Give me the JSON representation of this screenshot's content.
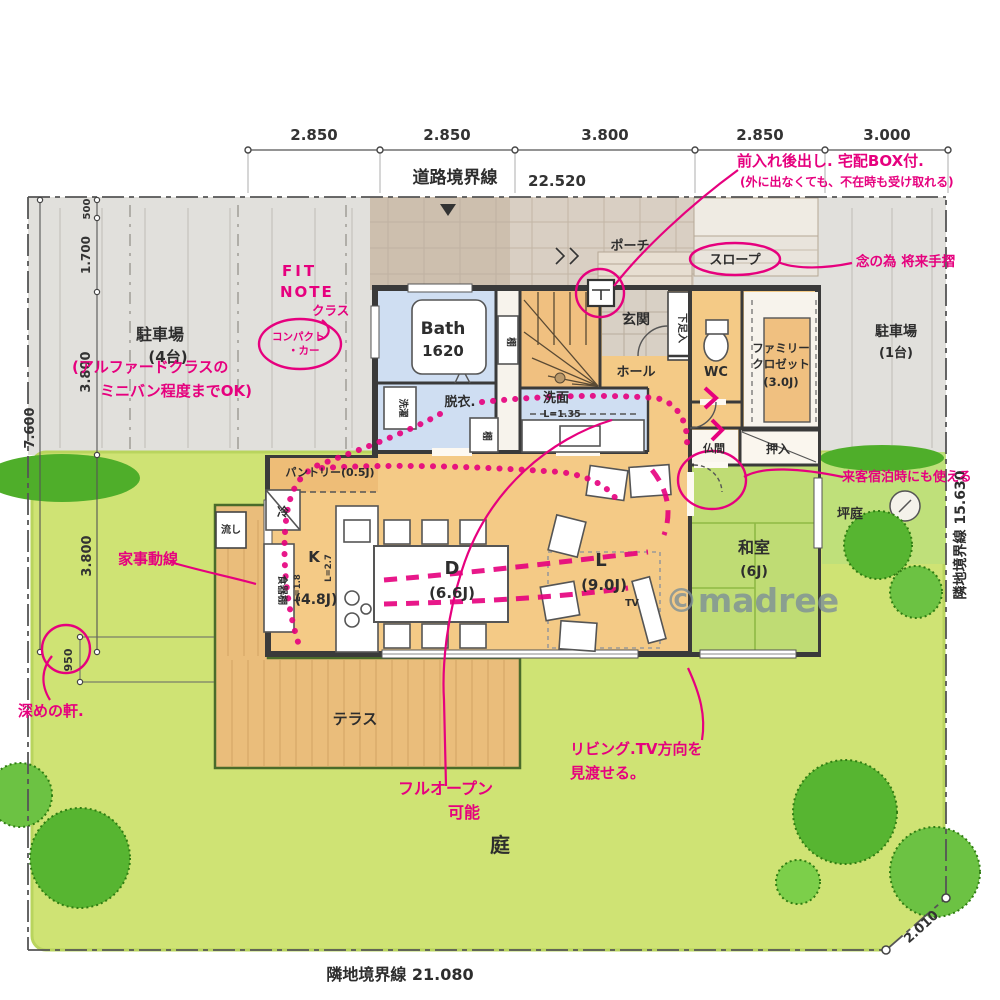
{
  "colors": {
    "accent_pink": "#e6007e",
    "lawn_green": "#cfe374",
    "floor_orange": "#f4ca86",
    "tatami_green": "#bfdc74",
    "water_blue": "#cfdef2",
    "road_gray": "#e1e0dc"
  },
  "boundary": {
    "road_label": "道路境界線",
    "road_len": "22.520",
    "bottom_label": "隣地境界線 21.080",
    "right_label": "隣地境界線 15.630",
    "corner_len": "2.010"
  },
  "dims": {
    "top": [
      "2.850",
      "2.850",
      "3.800",
      "2.850",
      "3.000"
    ],
    "v500": "500",
    "v1700": "1.700",
    "v3800a": "3.800",
    "v7600": "7.600",
    "v3800b": "3.800",
    "eave": "950"
  },
  "rooms": {
    "bath_name": "Bath",
    "bath_size": "1620",
    "datsui": "脱衣.",
    "senmen": "洗面",
    "senmen_len": "L=1.35",
    "tana1": "棚",
    "tana2": "棚",
    "washer": "洗濯",
    "pantry": "パントリー(0.5J)",
    "k_name": "K",
    "k_size": "(4.8J)",
    "k_len1": "L=1.8",
    "k_len2": "L=2.7",
    "cupboard": "食器棚",
    "fridge": "冷",
    "d_name": "D",
    "d_size": "(6.6J)",
    "l_name": "L",
    "l_size": "(9.0J)",
    "tv": "TV",
    "washitsu_name": "和室",
    "washitsu_size": "(6J)",
    "butsuma": "仏間",
    "oshiire": "押入",
    "wc": "WC",
    "fc1": "ファミリー",
    "fc2": "クロゼット",
    "fc3": "(3.0J)",
    "genkan": "玄関",
    "hall": "ホール",
    "porch": "ポーチ",
    "shoe": "下足入",
    "slope": "スロープ",
    "terrace": "テラス",
    "garden": "庭",
    "tsuboniwa": "坪庭",
    "sink": "流し",
    "parking_l1": "駐車場",
    "parking_l2": "(4台)",
    "parking_r1": "駐車場",
    "parking_r2": "(1台)"
  },
  "notes": {
    "delivery1": "前入れ後出し. 宅配BOX付.",
    "delivery2": "(外に出なくても、不在時も受け取れる)",
    "handrail": "念の為 将来手摺",
    "fit1": "FIT",
    "fit2": "NOTE",
    "fit3": "クラス",
    "compact1": "コンパクト",
    "compact2": "・カー",
    "minivan1": "(アルファードクラスの",
    "minivan2": "ミニバン程度までOK)",
    "kaji": "家事動線",
    "eave_note": "深めの軒.",
    "fullopen1": "フルオープン",
    "fullopen2": "可能",
    "view1": "リビング.TV方向を",
    "view2": "見渡せる。",
    "guest": "来客宿泊時にも使える"
  },
  "watermark": "©madree"
}
